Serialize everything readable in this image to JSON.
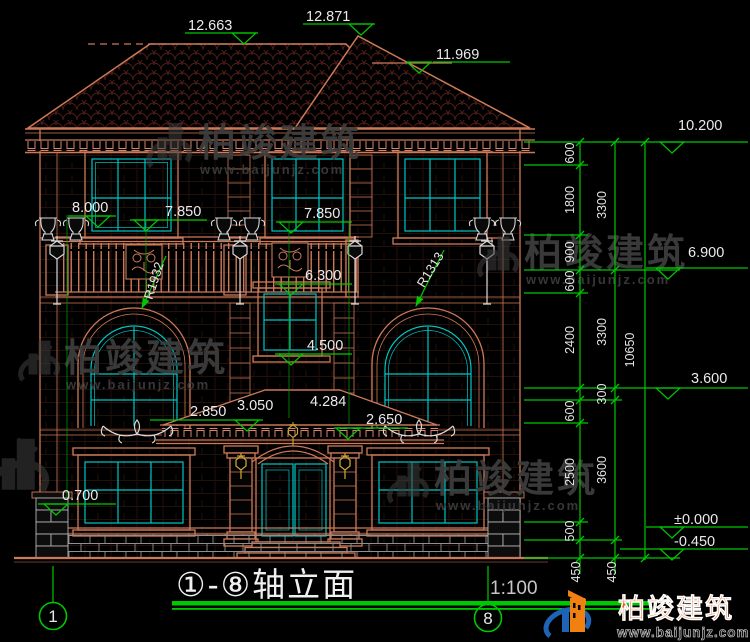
{
  "title_block": {
    "title": "①-⑧轴立面",
    "scale": "1:100"
  },
  "axis_bubbles": {
    "left": "1",
    "right": "8"
  },
  "watermark": {
    "brand": "柏竣建筑",
    "url": "www.baijunjz.com"
  },
  "logo": {
    "brand": "柏竣建筑",
    "url": "www.baijunjz.com"
  },
  "elevations": {
    "ridge_left": "12.663",
    "ridge_right": "12.871",
    "eave_upper": "11.969",
    "cornice": "10.200",
    "level_8000": "8.000",
    "level_7850_left": "7.850",
    "level_7850_right": "7.850",
    "level_6900": "6.900",
    "level_6300": "6.300",
    "level_4500": "4.500",
    "level_3600": "3.600",
    "porch_2850": "2.850",
    "porch_3050": "3.050",
    "porch_4284": "4.284",
    "porch_2650": "2.650",
    "level_0700": "0.700",
    "level_zero": "±0.000",
    "level_minus_450": "-0.450"
  },
  "radii": {
    "left_arch": "R1932",
    "right_arch": "R1313"
  },
  "dims": {
    "inner": [
      "600",
      "1800",
      "900",
      "600",
      "2400",
      "600",
      "2500",
      "500",
      "450"
    ],
    "middle": [
      "3300",
      "3300",
      "300",
      "3600",
      "450"
    ],
    "outer": [
      "10650"
    ]
  },
  "colors": {
    "background": "#000000",
    "line_salmon": "#cd7a58",
    "roof_tile": "#4f1d18",
    "glass_cyan": "#00c6c6",
    "dimension_green": "#00c800",
    "text_white": "#e8e8e8",
    "watermark_gray": "#3e3e3e",
    "brand_orange": "#e8590f",
    "brand_blue": "#1e63b5",
    "lamp_gold": "#c8a235"
  }
}
